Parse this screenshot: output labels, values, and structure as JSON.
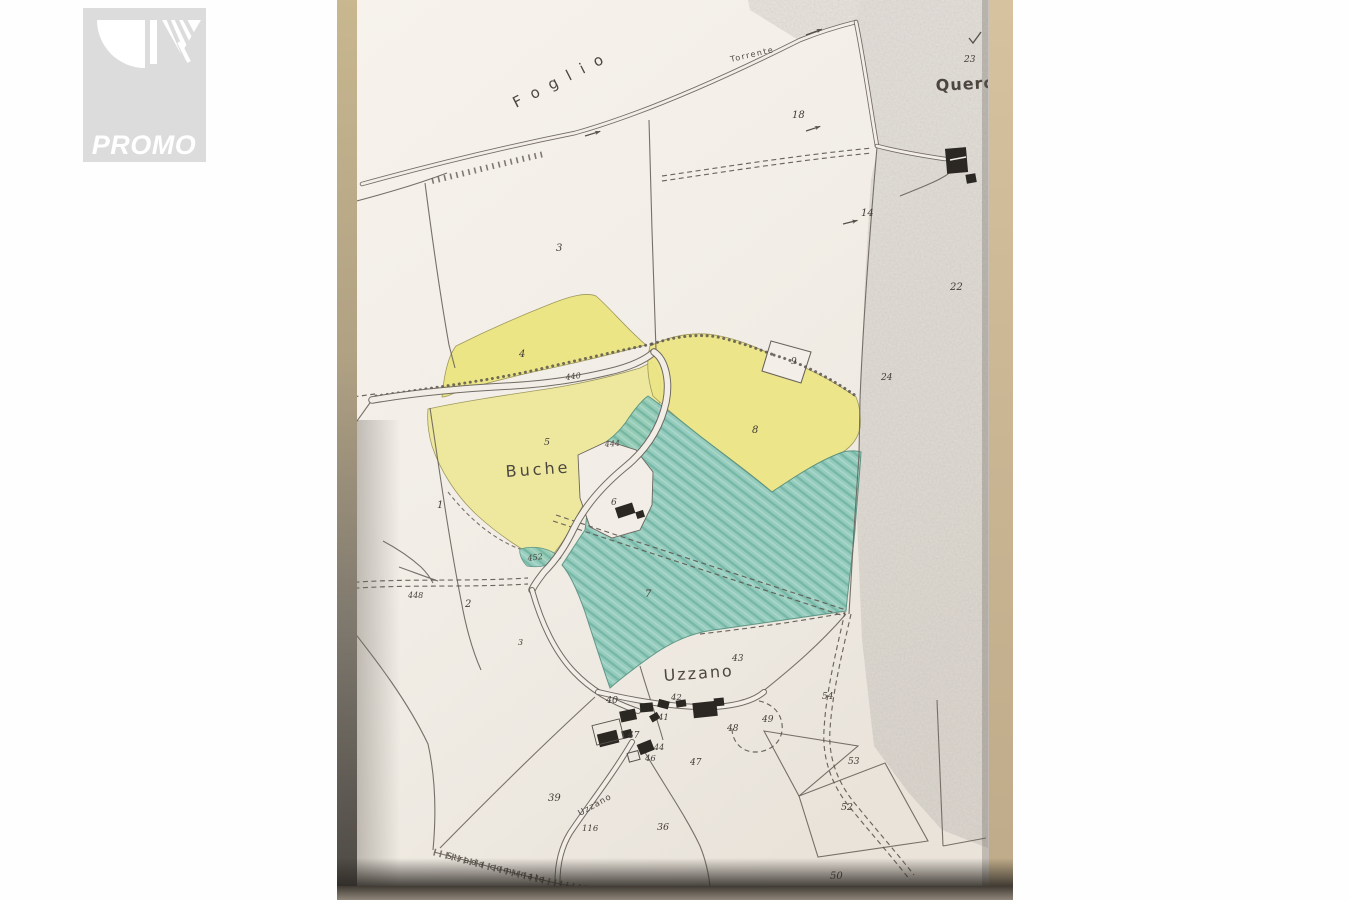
{
  "watermark": {
    "label": "PROMO",
    "bg_color": "#dcdcdc",
    "fg_color": "#ffffff"
  },
  "map": {
    "colors": {
      "paper": "#f2eee7",
      "parcel_yellow": "#ece586",
      "parcel_yellow_light": "#efe99c",
      "parcel_teal": "#8ecabb",
      "teal_hatch": "#6db3a2",
      "map_line": "#6b655d",
      "photo_edge_tan": "#c9b592",
      "photo_shadow": "#3f3a33"
    },
    "region_labels": [
      {
        "name": "label-foglio",
        "text": "Foglio",
        "x": 516,
        "y": 108,
        "size": 15,
        "rot": -27,
        "ls": 11,
        "weight": "normal",
        "color": "#5a554e"
      },
      {
        "name": "label-torrente",
        "text": "Torrente",
        "x": 731,
        "y": 62,
        "size": 8,
        "rot": -13,
        "ls": 1.5,
        "weight": "normal",
        "color": "#4c463f"
      },
      {
        "name": "label-querceto",
        "text": "Querc",
        "x": 936,
        "y": 91,
        "size": 16,
        "rot": -3,
        "ls": 1,
        "weight": "bold",
        "color": "#443f39"
      },
      {
        "name": "label-buche",
        "text": "Buche",
        "x": 506,
        "y": 477,
        "size": 16,
        "rot": -4,
        "ls": 3,
        "weight": "normal",
        "color": "#3f3a34"
      },
      {
        "name": "label-uzzano-village",
        "text": "Uzzano",
        "x": 664,
        "y": 681,
        "size": 16,
        "rot": -4,
        "ls": 2,
        "weight": "normal",
        "color": "#3f3a34"
      },
      {
        "name": "label-uzzano-road",
        "text": "Uzzano",
        "x": 580,
        "y": 816,
        "size": 8.5,
        "rot": -29,
        "ls": 1,
        "weight": "normal",
        "color": "#4c463f"
      },
      {
        "name": "label-strada-comunale",
        "text": "Strada comunale",
        "x": 446,
        "y": 858,
        "size": 8.5,
        "rot": 14,
        "ls": 2,
        "weight": "normal",
        "color": "#4c463f"
      }
    ],
    "parcel_numbers": [
      {
        "n": "18",
        "x": 792,
        "y": 118
      },
      {
        "n": "23",
        "x": 964,
        "y": 62,
        "s": 9
      },
      {
        "n": "14",
        "x": 861,
        "y": 216
      },
      {
        "n": "22",
        "x": 950,
        "y": 290
      },
      {
        "n": "24",
        "x": 881,
        "y": 380,
        "s": 9
      },
      {
        "n": "3",
        "x": 556,
        "y": 251
      },
      {
        "n": "4",
        "x": 519,
        "y": 357
      },
      {
        "n": "9",
        "x": 791,
        "y": 364,
        "s": 9
      },
      {
        "n": "5",
        "x": 544,
        "y": 445,
        "s": 9.5
      },
      {
        "n": "8",
        "x": 752,
        "y": 433
      },
      {
        "n": "1",
        "x": 437,
        "y": 508
      },
      {
        "n": "6",
        "x": 611,
        "y": 505,
        "s": 9
      },
      {
        "n": "7",
        "x": 645,
        "y": 597
      },
      {
        "n": "2",
        "x": 465,
        "y": 607
      },
      {
        "n": "3",
        "x": 518,
        "y": 645,
        "s": 8
      },
      {
        "n": "43",
        "x": 732,
        "y": 661,
        "s": 9
      },
      {
        "n": "40",
        "x": 606,
        "y": 703,
        "s": 9.5
      },
      {
        "n": "42",
        "x": 671,
        "y": 700,
        "s": 8.5
      },
      {
        "n": "41",
        "x": 658,
        "y": 720,
        "s": 8.5
      },
      {
        "n": "48",
        "x": 727,
        "y": 731,
        "s": 9
      },
      {
        "n": "49",
        "x": 762,
        "y": 722,
        "s": 9
      },
      {
        "n": "54",
        "x": 822,
        "y": 699,
        "s": 9
      },
      {
        "n": "47",
        "x": 628,
        "y": 738,
        "s": 9
      },
      {
        "n": "44",
        "x": 654,
        "y": 750,
        "s": 8
      },
      {
        "n": "46",
        "x": 645,
        "y": 761,
        "s": 8.5
      },
      {
        "n": "47",
        "x": 690,
        "y": 765,
        "s": 9
      },
      {
        "n": "53",
        "x": 848,
        "y": 764,
        "s": 9
      },
      {
        "n": "52",
        "x": 841,
        "y": 810,
        "s": 9.5
      },
      {
        "n": "39",
        "x": 548,
        "y": 801,
        "s": 10
      },
      {
        "n": "116",
        "x": 582,
        "y": 831,
        "s": 8.5
      },
      {
        "n": "36",
        "x": 657,
        "y": 830,
        "s": 9.5
      },
      {
        "n": "50",
        "x": 830,
        "y": 879,
        "s": 10
      }
    ],
    "spot_elevations": [
      {
        "v": "440",
        "x": 566,
        "y": 380,
        "rot": -8
      },
      {
        "v": "444",
        "x": 605,
        "y": 447,
        "rot": -5
      },
      {
        "v": "452",
        "x": 528,
        "y": 561,
        "rot": -8
      },
      {
        "v": "448",
        "x": 408,
        "y": 598,
        "rot": 0
      }
    ]
  }
}
